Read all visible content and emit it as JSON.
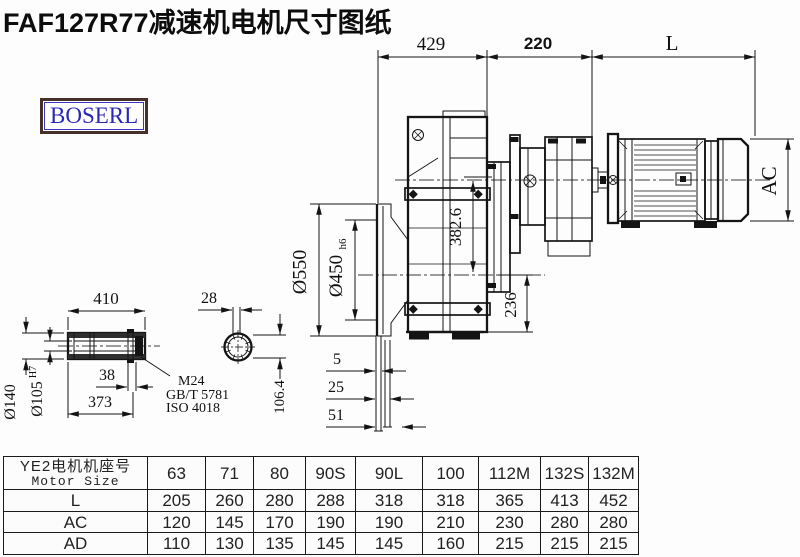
{
  "title": "FAF127R77减速机电机尺寸图纸",
  "logo": {
    "text": "BOSERL"
  },
  "colors": {
    "line": "#151515",
    "title": "#0d0d0d",
    "logo_text": "#2b27b8",
    "logo_border": "#46302a",
    "hatch_band": "#2e2e2e"
  },
  "drawing": {
    "top_dims": {
      "d429": "429",
      "d220": "220",
      "dL": "L"
    },
    "main_dims": {
      "flange_od": "Ø550",
      "spigot": "Ø450",
      "spigot_tol": "h6",
      "center_height": "382.6",
      "base_height": "236",
      "motor_ac": "AC",
      "off5": "5",
      "off25": "25",
      "off51": "51"
    },
    "shaft_dims": {
      "len410": "410",
      "od140": "Ø140",
      "bore105": "Ø105",
      "bore_tol": "H7",
      "groove38": "38",
      "len373": "373",
      "key28": "28",
      "flat106": "106.4"
    },
    "callout": {
      "line1": "M24",
      "line2": "GB/T 5781",
      "line3": "ISO 4018"
    }
  },
  "table": {
    "header": {
      "line1": "YE2电机机座号",
      "line2": "Motor Size"
    },
    "columns": [
      "63",
      "71",
      "80",
      "90S",
      "90L",
      "100",
      "112M",
      "132S",
      "132M"
    ],
    "rows": [
      {
        "label": "L",
        "values": [
          "205",
          "260",
          "280",
          "288",
          "318",
          "318",
          "365",
          "413",
          "452"
        ]
      },
      {
        "label": "AC",
        "values": [
          "120",
          "145",
          "170",
          "190",
          "190",
          "210",
          "230",
          "280",
          "280"
        ]
      },
      {
        "label": "AD",
        "values": [
          "110",
          "130",
          "135",
          "145",
          "145",
          "160",
          "215",
          "215",
          "215"
        ]
      }
    ]
  }
}
